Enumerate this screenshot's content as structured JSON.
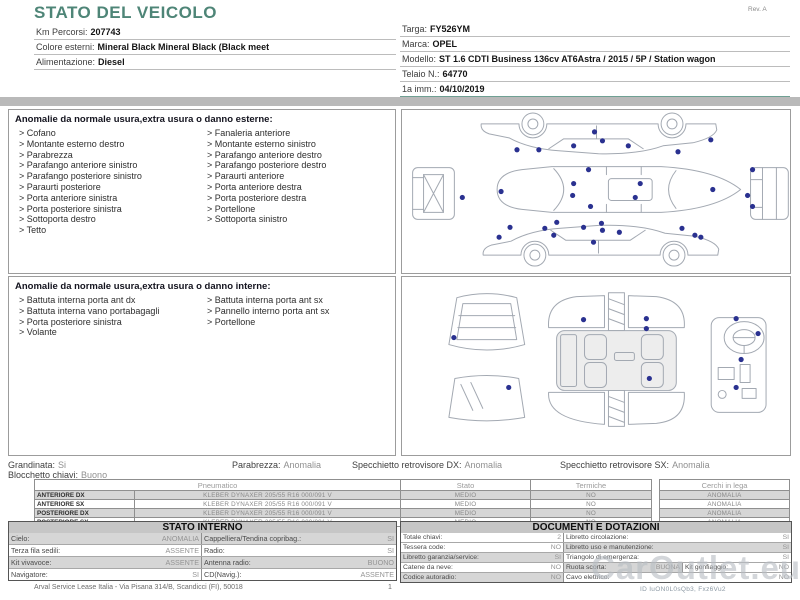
{
  "header": {
    "title": "STATO DEL VEICOLO",
    "rev": "Rev. A",
    "left_fields": [
      {
        "label": "Km Percorsi:",
        "value": "207743"
      },
      {
        "label": "Colore esterni:",
        "value": "Mineral Black Mineral Black (Black meet"
      },
      {
        "label": "Alimentazione:",
        "value": "Diesel"
      }
    ],
    "right_fields": [
      {
        "label": "Targa:",
        "value": "FY526YM"
      },
      {
        "label": "Marca:",
        "value": "OPEL"
      },
      {
        "label": "Modello:",
        "value": "ST 1.6 CDTI Business 136cv AT6Astra / 2015 / 5P / Station wagon"
      },
      {
        "label": "Telaio N.:",
        "value": "64770"
      },
      {
        "label": "1a imm.:",
        "value": "04/10/2019"
      }
    ]
  },
  "exterior": {
    "title": "Anomalie da normale usura,extra usura o danno esterne:",
    "col1": [
      "Cofano",
      "Montante esterno destro",
      "Parabrezza",
      "Parafango anteriore sinistro",
      "Parafango posteriore sinistro",
      "Paraurti posteriore",
      "Porta anteriore sinistra",
      "Porta posteriore sinistra",
      "Sottoporta destro",
      "Tetto"
    ],
    "col2": [
      "Fanaleria anteriore",
      "Montante esterno sinistro",
      "Parafango anteriore destro",
      "Parafango posteriore destro",
      "Paraurti anteriore",
      "Porta anteriore destra",
      "Porta posteriore destra",
      "Portellone",
      "Sottoporta sinistro"
    ]
  },
  "interior": {
    "title": "Anomalie da normale usura,extra usura o danno interne:",
    "col1": [
      "Battuta interna porta ant dx",
      "Battuta interna vano portabagagli",
      "Porta posteriore sinistra",
      "Volante"
    ],
    "col2": [
      "Battuta interna porta ant sx",
      "Pannello interno porta ant sx",
      "Portellone"
    ]
  },
  "summary": {
    "grandinata_label": "Grandinata:",
    "grandinata_value": "Si",
    "blocchetto_label": "Blocchetto chiavi:",
    "blocchetto_value": "Buono",
    "parabrezza_label": "Parabrezza:",
    "parabrezza_value": "Anomalia",
    "specchietto_dx_label": "Specchietto retrovisore DX:",
    "specchietto_dx_value": "Anomalia",
    "specchietto_sx_label": "Specchietto retrovisore SX:",
    "specchietto_sx_value": "Anomalia"
  },
  "tires": {
    "col_pneumatico": "Pneumatico",
    "col_stato": "Stato",
    "col_termiche": "Termiche",
    "col_cerchi": "Cerchi in lega",
    "rows": [
      {
        "position": "ANTERIORE DX",
        "tire": "KLEBER DYNAXER 205/55 R16 000/091 V",
        "stato": "MEDIO",
        "termiche": "NO",
        "cerchi": "ANOMALIA"
      },
      {
        "position": "ANTERIORE SX",
        "tire": "KLEBER DYNAXER 205/55 R16 000/091 V",
        "stato": "MEDIO",
        "termiche": "NO",
        "cerchi": "ANOMALIA"
      },
      {
        "position": "POSTERIORE DX",
        "tire": "KLEBER DYNAXER 205/55 R16 000/091 V",
        "stato": "MEDIO",
        "termiche": "NO",
        "cerchi": "ANOMALIA"
      },
      {
        "position": "POSTERIORE SX",
        "tire": "KLEBER DYNAXER 205/55 R16 000/091 V",
        "stato": "MEDIO",
        "termiche": "NO",
        "cerchi": "ANOMALIA"
      }
    ]
  },
  "stato_interno": {
    "title": "STATO INTERNO",
    "rows": [
      {
        "l1": "Cielo:",
        "v1": "ANOMALIA",
        "l2": "Cappelliera/Tendina copribag.:",
        "v2": "SI"
      },
      {
        "l1": "Terza fila sedili:",
        "v1": "ASSENTE",
        "l2": "Radio:",
        "v2": "SI"
      },
      {
        "l1": "Kit vivavoce:",
        "v1": "ASSENTE",
        "l2": "Antenna radio:",
        "v2": "BUONO"
      },
      {
        "l1": "Navigatore:",
        "v1": "SI",
        "l2": "CD(Navig.):",
        "v2": "ASSENTE"
      }
    ]
  },
  "documenti": {
    "title": "DOCUMENTI E DOTAZIONI",
    "rows": [
      {
        "l1": "Totale chiavi:",
        "v1": "2",
        "l2": "Libretto circolazione:",
        "v2": "SI"
      },
      {
        "l1": "Tessera code:",
        "v1": "NO",
        "l2": "Libretto uso e manutenzione:",
        "v2": "SI"
      },
      {
        "l1": "Libretto garanzia/service:",
        "v1": "SI",
        "l2": "Triangolo di emergenza:",
        "v2": "SI"
      },
      {
        "l1": "Catene da neve:",
        "v1": "NO",
        "l2": "Ruota scorta:",
        "v2": "BUONA",
        "l3": "Kit gonfiaggio:",
        "v3": "NO"
      },
      {
        "l1": "Codice autoradio:",
        "v1": "NO",
        "l2": "Cavo elettrico:",
        "v2": "NO"
      }
    ]
  },
  "diagrams": {
    "exterior_dots": [
      [
        193,
        22
      ],
      [
        115,
        40
      ],
      [
        137,
        40
      ],
      [
        172,
        36
      ],
      [
        201,
        31
      ],
      [
        227,
        36
      ],
      [
        277,
        42
      ],
      [
        310,
        30
      ],
      [
        187,
        60
      ],
      [
        99,
        82
      ],
      [
        172,
        74
      ],
      [
        171,
        86
      ],
      [
        189,
        97
      ],
      [
        239,
        74
      ],
      [
        234,
        88
      ],
      [
        312,
        80
      ],
      [
        60,
        88
      ],
      [
        352,
        60
      ],
      [
        347,
        86
      ],
      [
        352,
        97
      ],
      [
        97,
        128
      ],
      [
        108,
        118
      ],
      [
        143,
        119
      ],
      [
        152,
        126
      ],
      [
        155,
        113
      ],
      [
        182,
        118
      ],
      [
        200,
        114
      ],
      [
        201,
        121
      ],
      [
        218,
        123
      ],
      [
        192,
        133
      ],
      [
        281,
        119
      ],
      [
        294,
        126
      ],
      [
        300,
        128
      ]
    ],
    "interior_dots": [
      [
        52,
        60
      ],
      [
        107,
        110
      ],
      [
        182,
        42
      ],
      [
        245,
        41
      ],
      [
        245,
        51
      ],
      [
        248,
        101
      ],
      [
        335,
        41
      ],
      [
        357,
        56
      ],
      [
        340,
        82
      ],
      [
        335,
        110
      ]
    ]
  },
  "watermark": {
    "text": "CarOutlet.eu",
    "id_line": "ID IuON0L0sQb3, Fxz6Vu2"
  },
  "footer": {
    "company": "Arval Service Lease Italia - Via Pisana 314/B, Scandicci (FI), 50018",
    "page": "1"
  },
  "colors": {
    "accent_teal": "#4e8577",
    "damage_dot_blue": "#2a3190",
    "band_gray": "#b9b9b9"
  }
}
